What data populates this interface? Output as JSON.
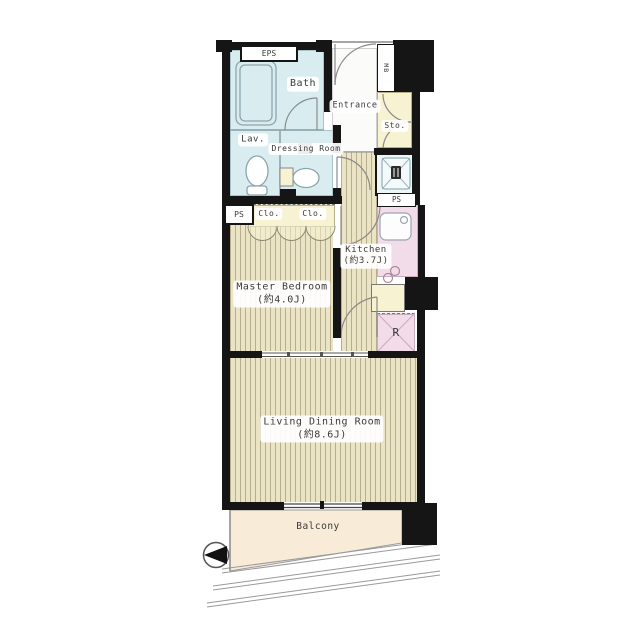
{
  "floorplan": {
    "rooms": {
      "bath": {
        "label": "Bath"
      },
      "lavatory": {
        "label": "Lav."
      },
      "dressing_room": {
        "label": "Dressing Room"
      },
      "entrance": {
        "label": "Entrance"
      },
      "storage": {
        "label": "Sto."
      },
      "master_bedroom": {
        "label": "Master Bedroom",
        "size": "(約4.0J)"
      },
      "kitchen": {
        "label": "Kitchen",
        "size": "(約3.7J)"
      },
      "living_dining": {
        "label": "Living Dining Room",
        "size": "(約8.6J)"
      },
      "balcony": {
        "label": "Balcony"
      }
    },
    "utility": {
      "eps": "EPS",
      "mb": "MB",
      "ps_bedroom": "PS",
      "ps_laundry": "PS",
      "closet_left": "Clo.",
      "closet_right": "Clo.",
      "refrigerator": "R"
    },
    "colors": {
      "wall": "#151515",
      "wet_room": "#d9edf1",
      "kitchen": "#f3dcea",
      "closet": "#f6f2d2",
      "flooring": "#ebe4c4",
      "flooring_stripe": "#b7ae90",
      "balcony": "#f8ecd9"
    }
  }
}
